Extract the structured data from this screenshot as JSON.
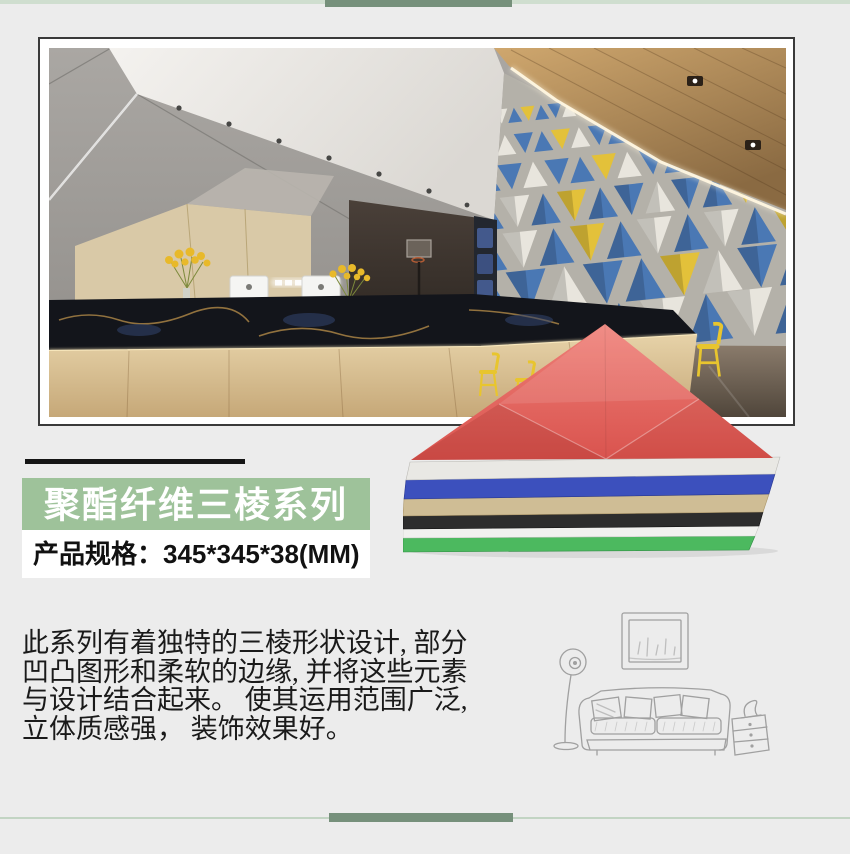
{
  "page": {
    "background": "#ececec"
  },
  "decor": {
    "top_band_color": "#cfdecf",
    "top_accent_bar_color": "#76907b",
    "bottom_line_color": "#c2d4c3",
    "bottom_accent_bar_color": "#76907b",
    "title_accent_bar_color": "#151515"
  },
  "scene": {
    "panel_colors": [
      "#4a78b4",
      "#e8e5dd",
      "#e3c13a"
    ],
    "wood_ceiling_color": "#c49b63",
    "feature_wall_color": "#b4b1a9",
    "chair_color": "#e8c52e"
  },
  "series_banner": {
    "title": "聚酯纤维三棱系列",
    "background": "#9ec29a",
    "text_color": "#ffffff"
  },
  "spec_box": {
    "text": "产品规格：345*345*38(MM)",
    "background": "#ffffff",
    "text_color": "#111111"
  },
  "description": {
    "lines": [
      "此系列有着独特的三棱形状设计, 部分",
      "凹凸图形和柔软的边缘, 并将这些元素",
      "与设计结合起来。 使其运用范围广泛,",
      "立体质感强， 装饰效果好。"
    ]
  },
  "product_stack": {
    "layers": [
      {
        "name": "red-triangle-panel",
        "color": "#e4675f"
      },
      {
        "name": "white-panel",
        "color": "#e9e8e4"
      },
      {
        "name": "blue-panel",
        "color": "#3c50bd"
      },
      {
        "name": "tan-panel",
        "color": "#cfbd95"
      },
      {
        "name": "black-panel",
        "color": "#2d2d2d"
      },
      {
        "name": "white-panel-2",
        "color": "#f1f1ef"
      },
      {
        "name": "green-panel",
        "color": "#4cb95f"
      }
    ]
  }
}
